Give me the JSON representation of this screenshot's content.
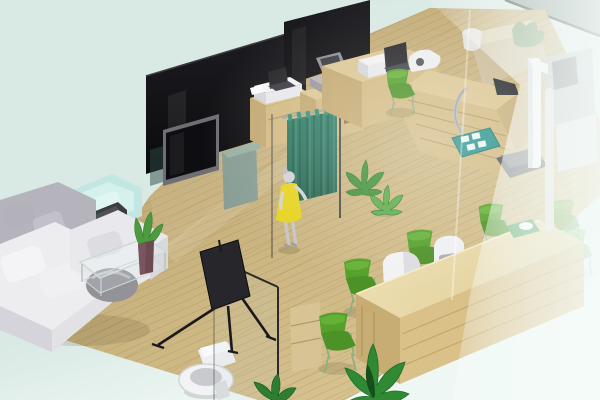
{
  "scene": {
    "kind": "3d-isometric-interior-render",
    "setting": "clinic-office showroom floorplan on pale mint backdrop",
    "rooms": [
      {
        "name": "lounge",
        "objects": [
          "white-l-sofa",
          "grey-ball-cushion",
          "teal-armchair",
          "dark-office-chair",
          "glass-coffee-table",
          "plant-in-vase",
          "black-banner-stand"
        ]
      },
      {
        "name": "consult-cubicles",
        "objects": [
          "black-glass-wall-left",
          "black-glass-wall-right",
          "wall-tv",
          "glass-partition",
          "steel-cabinet",
          "wood-cabinet-printer",
          "wood-cabinet-register",
          "teal-privacy-curtain",
          "standing-person-yellow-dress",
          "floor-plant-small-a",
          "floor-plant-small-b"
        ]
      },
      {
        "name": "exam-area",
        "objects": [
          "wood-exam-counter",
          "laptop",
          "printer",
          "imaging-device",
          "tablet-panel",
          "silver-hose-arm",
          "stadiometer-scale",
          "teal-foot-mat",
          "green-chair-exam"
        ]
      },
      {
        "name": "bathroom",
        "objects": [
          "glass-enclosure",
          "door-handle",
          "toilet",
          "wood-shelf"
        ]
      },
      {
        "name": "reception",
        "objects": [
          "long-wood-reception-desk",
          "white-reception-chair",
          "white-device-chair",
          "green-tray-with-mouse",
          "green-waiting-chairs-x6",
          "leafy-floor-plant",
          "small-floor-plant"
        ]
      },
      {
        "name": "behind-frosted-glass",
        "objects": [
          "frosted-glass-wall",
          "white-frame-pillar",
          "back-cabinets",
          "back-desk-monitor",
          "back-plant"
        ]
      }
    ]
  },
  "palette": {
    "bgMint": "#d9e9e4",
    "bgMintLight": "#eef7f3",
    "floorLight": "#d8c492",
    "floorBase": "#c9b37e",
    "floorDark": "#b39a68",
    "wallBlack": "#0b0b0d",
    "wallBlackSoft": "#1d1d22",
    "curtainTeal": "#2e7f66",
    "curtainTealDark": "#246550",
    "chairGreen": "#55a02a",
    "chairGreenLight": "#6cb83d",
    "deskTopLight": "#eee0b4",
    "deskFront": "#d9c189",
    "deskEnd": "#c7ad74",
    "cabinetTop": "#dcc794",
    "cabinetSide": "#d2ba82",
    "cabinetDark": "#c2a972",
    "sofaWhite": "#ededf0",
    "sofaShade": "#d4d4da",
    "sofaGrey": "#b5b4bc",
    "armchairTeal": "#c2e7e2",
    "armchairTealShade": "#aedcd6",
    "dressYellow": "#e6d31f",
    "matTeal": "#27948a",
    "frostWhite": "#f6fcfa",
    "plantGreen": "#3e8f36",
    "plantGreenDark": "#1e6b26"
  }
}
